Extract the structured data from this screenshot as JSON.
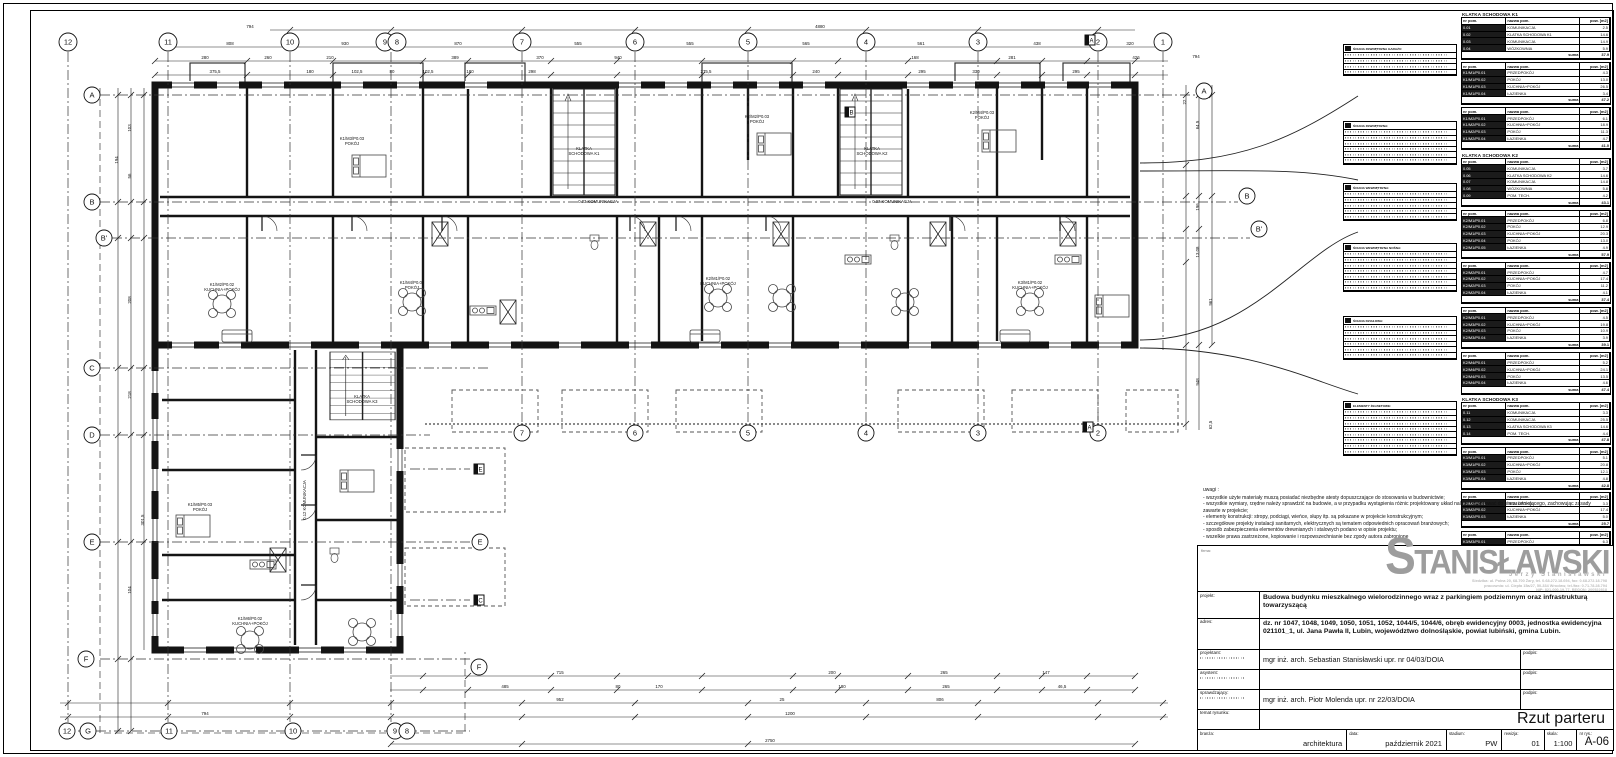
{
  "sheet": {
    "drawing_title": "Rzut parteru",
    "drawing_number": "A-06"
  },
  "notes": {
    "label": "uwagi :",
    "lines": [
      "- wszystkie użyte materiały muszą posiadać niezbędne atesty dopuszczające do stosowania w budownictwie;",
      "- wszystkie wymiary, rzędne należy sprawdzić na budowie, a w przypadku wystąpienia różnic projektowany układ należy dostosować do stanu istniejącego, zachowując zasady zawarte w projekcie;",
      "- elementy konstrukcji: stropy, podciągi, wieńce, słupy itp. są pokazane w projekcie konstrukcyjnym;",
      "- szczegółowe projekty instalacji sanitarnych, elektrycznych są tematem odpowiednich opracowań branżowych;",
      "- sposób zabezpieczenia elementów drewnianych i stalowych podano w opisie projektu;",
      "- wszelkie prawa zastrzeżone, kopiowanie i rozpowszechnianie bez zgody autora zabronione"
    ]
  },
  "logo": {
    "firma_label": "firma:",
    "name_initial": "S",
    "name_rest": "TANISŁAWSKI",
    "name_sub": "Jerzy Stanisławski",
    "addr1": "Siedziba: ul. Polna 20, 68-700 Żary, tel. 0.68.272.18.694, fax: 0.68.272.18.798",
    "addr2": "pracownia: ul. Ciepła 15a/27, 50-334 Wrocław, tel./fax: 0.71.78.28.794",
    "addr3": "NIP: 821-000-19-77, REGON: 200522818"
  },
  "titleblock": {
    "projekt_label": "projekt:",
    "projekt": "Budowa budynku mieszkalnego wielorodzinnego wraz z parkingiem podziemnym oraz infrastrukturą towarzyszącą",
    "adres_label": "adres:",
    "adres": "dz. nr 1047, 1048, 1049, 1050, 1051, 1052, 1044/5, 1044/6, obręb ewidencyjny 0003, jednostka ewidencyjna 021101_1, ul. Jana Pawła II, Lubin, województwo dolnośląskie, powiat lubiński, gmina Lubin.",
    "projektant_label": "projektant:",
    "projektant": "mgr inż. arch. Sebastian Stanisławski upr. nr 04/03/DOIA",
    "asystent_label": "asystent:",
    "asystent": "",
    "sprawdzajacy_label": "sprawdzający:",
    "sprawdzajacy": "mgr inż. arch. Piotr Molenda upr. nr 22/03/DOIA",
    "podpis_label": "podpis:",
    "temat_label": "temat rysunku:",
    "temat": "Rzut parteru",
    "bottom": [
      {
        "label": "branża:",
        "value": "architektura",
        "w": 150
      },
      {
        "label": "data:",
        "value": "październik 2021",
        "w": 100
      },
      {
        "label": "stadium:",
        "value": "PW",
        "w": 55
      },
      {
        "label": "rewizja:",
        "value": "01",
        "w": 42
      },
      {
        "label": "skala:",
        "value": "1:100",
        "w": 32
      },
      {
        "label": "nr rys.:",
        "value": "A-06",
        "w": 36,
        "big": true
      }
    ]
  },
  "legend": {
    "col_headers": [
      "nr pom.",
      "nazwa pom.",
      "pow. [m2]"
    ],
    "suma_label": "suma",
    "materials": [
      {
        "top": 33,
        "rows": 4,
        "title": "ŚCIANA ZEWNĘTRZNA GARAŻU:"
      },
      {
        "top": 110,
        "rows": 6,
        "title": "ŚCIANA ZEWNĘTRZNA:"
      },
      {
        "top": 172,
        "rows": 5,
        "title": "ŚCIANA WEWNĘTRZNA:"
      },
      {
        "top": 232,
        "rows": 7,
        "title": "ŚCIANA WEWNĘTRZNA NOŚNA:"
      },
      {
        "top": 305,
        "rows": 6,
        "title": "ŚCIANA DZIAŁOWA:"
      },
      {
        "top": 390,
        "rows": 8,
        "title": "ELEMENTY ŻELBETOWE:"
      }
    ],
    "sections": [
      {
        "title": "KLATKA SCHODOWA K1",
        "tables": [
          {
            "rows": [
              [
                "0.01",
                "KOMUNIKACJA",
                "2.5"
              ],
              [
                "0.02",
                "KLATKA SCHODOWA K1",
                "14.6"
              ],
              [
                "0.03",
                "KOMUNIKACJA",
                "14.9"
              ],
              [
                "0.04",
                "WÓZKOWNIA",
                "5.9"
              ]
            ],
            "sum": "37.9"
          },
          {
            "rows": [
              [
                "K1/M1/P0.01",
                "PRZEDPOKÓJ",
                "4.3"
              ],
              [
                "K1/M1/P0.02",
                "POKÓJ",
                "13.0"
              ],
              [
                "K1/M1/P0.03",
                "KUCHNIA+POKÓJ",
                "26.5"
              ],
              [
                "K1/M1/P0.04",
                "ŁAZIENKA",
                "3.4"
              ]
            ],
            "sum": "47.2"
          },
          {
            "rows": [
              [
                "K1/M2/P0.01",
                "PRZEDPOKÓJ",
                "6.1"
              ],
              [
                "K1/M2/P0.02",
                "KUCHNIA+POKÓJ",
                "18.9"
              ],
              [
                "K1/M2/P0.03",
                "POKÓJ",
                "11.3"
              ],
              [
                "K1/M2/P0.04",
                "ŁAZIENKA",
                "4.7"
              ]
            ],
            "sum": "41.0"
          }
        ]
      },
      {
        "title": "KLATKA SCHODOWA K2",
        "tables": [
          {
            "rows": [
              [
                "0.05",
                "KOMUNIKACJA",
                "3.7"
              ],
              [
                "0.06",
                "KLATKA SCHODOWA K2",
                "14.6"
              ],
              [
                "0.07",
                "KOMUNIKACJA",
                "14.8"
              ],
              [
                "0.08",
                "WÓZKOWNIA",
                "5.8"
              ],
              [
                "0.09",
                "POM. TECH.",
                "4.2"
              ]
            ],
            "sum": "43.1"
          },
          {
            "rows": [
              [
                "K2/M1/P0.01",
                "PRZEDPOKÓJ",
                "6.8"
              ],
              [
                "K2/M1/P0.02",
                "POKÓJ",
                "12.9"
              ],
              [
                "K2/M1/P0.03",
                "KUCHNIA+POKÓJ",
                "20.3"
              ],
              [
                "K2/M1/P0.04",
                "POKÓJ",
                "13.0"
              ],
              [
                "K2/M1/P0.05",
                "ŁAZIENKA",
                "4.9"
              ]
            ],
            "sum": "57.9"
          },
          {
            "rows": [
              [
                "K2/M2/P0.01",
                "PRZEDPOKÓJ",
                "4.7"
              ],
              [
                "K2/M2/P0.02",
                "KUCHNIA+POKÓJ",
                "17.4"
              ],
              [
                "K2/M2/P0.03",
                "POKÓJ",
                "11.2"
              ],
              [
                "K2/M2/P0.04",
                "ŁAZIENKA",
                "4.1"
              ]
            ],
            "sum": "37.4"
          },
          {
            "rows": [
              [
                "K2/M3/P0.01",
                "PRZEDPOKÓJ",
                "4.5"
              ],
              [
                "K2/M3/P0.02",
                "KUCHNIA+POKÓJ",
                "19.8"
              ],
              [
                "K2/M3/P0.03",
                "POKÓJ",
                "10.9"
              ],
              [
                "K2/M3/P0.04",
                "ŁAZIENKA",
                "3.9"
              ]
            ],
            "sum": "39.1"
          },
          {
            "rows": [
              [
                "K2/M4/P0.01",
                "PRZEDPOKÓJ",
                "5.2"
              ],
              [
                "K2/M4/P0.02",
                "KUCHNIA+POKÓJ",
                "24.1"
              ],
              [
                "K2/M4/P0.03",
                "POKÓJ",
                "13.5"
              ],
              [
                "K2/M4/P0.04",
                "ŁAZIENKA",
                "4.6"
              ]
            ],
            "sum": "47.4"
          }
        ]
      },
      {
        "title": "KLATKA SCHODOWA K3",
        "tables": [
          {
            "rows": [
              [
                "0.11",
                "KOMUNIKACJA",
                "3.3"
              ],
              [
                "0.12",
                "KOMUNIKACJA",
                "25.5"
              ],
              [
                "0.13",
                "KLATKA SCHODOWA K3",
                "14.6"
              ],
              [
                "0.14",
                "POM. TECH.",
                "4.4"
              ]
            ],
            "sum": "47.8"
          },
          {
            "rows": [
              [
                "K3/M1/P0.01",
                "PRZEDPOKÓJ",
                "5.1"
              ],
              [
                "K3/M1/P0.02",
                "KUCHNIA+POKÓJ",
                "20.8"
              ],
              [
                "K3/M1/P0.03",
                "POKÓJ",
                "12.1"
              ],
              [
                "K3/M1/P0.04",
                "ŁAZIENKA",
                "4.8"
              ]
            ],
            "sum": "42.8"
          },
          {
            "rows": [
              [
                "K3/M2/P0.01",
                "PRZEDPOKÓJ",
                "3.3"
              ],
              [
                "K3/M2/P0.02",
                "KUCHNIA+POKÓJ",
                "17.4"
              ],
              [
                "K3/M2/P0.03",
                "ŁAZIENKA",
                "5.0"
              ]
            ],
            "sum": "25.7"
          },
          {
            "rows": [
              [
                "K3/M3/P0.01",
                "PRZEDPOKÓJ",
                "6.3"
              ],
              [
                "K3/M3/P0.02",
                "KUCHNIA+POKÓJ",
                "27.2"
              ],
              [
                "K3/M3/P0.03",
                "POKÓJ",
                "15.1"
              ],
              [
                "K3/M3/P0.04",
                "ŁAZIENKA",
                "4.2"
              ]
            ],
            "sum": "52.8"
          }
        ]
      }
    ]
  },
  "plan": {
    "grid_top": [
      {
        "x": 68,
        "l": "12"
      },
      {
        "x": 168,
        "l": "11"
      },
      {
        "x": 290,
        "l": "10"
      },
      {
        "x": 385,
        "l": "9"
      },
      {
        "x": 397,
        "l": "8"
      },
      {
        "x": 522,
        "l": "7"
      },
      {
        "x": 635,
        "l": "6"
      },
      {
        "x": 748,
        "l": "5"
      },
      {
        "x": 866,
        "l": "4"
      },
      {
        "x": 978,
        "l": "3"
      },
      {
        "x": 1098,
        "l": "2"
      },
      {
        "x": 1163,
        "l": "1"
      }
    ],
    "grid_mid": [
      {
        "x": 522,
        "l": "7"
      },
      {
        "x": 635,
        "l": "6"
      },
      {
        "x": 748,
        "l": "5"
      },
      {
        "x": 866,
        "l": "4"
      },
      {
        "x": 978,
        "l": "3"
      },
      {
        "x": 1098,
        "l": "2"
      }
    ],
    "grid_bottom": [
      {
        "x": 67,
        "l": "12"
      },
      {
        "x": 169,
        "l": "11"
      },
      {
        "x": 293,
        "l": "10"
      },
      {
        "x": 395,
        "l": "9"
      },
      {
        "x": 407,
        "l": "8"
      }
    ],
    "letters_left": [
      {
        "x": 92,
        "y": 95,
        "l": "A"
      },
      {
        "x": 92,
        "y": 202,
        "l": "B"
      },
      {
        "x": 104,
        "y": 238,
        "l": "B'"
      },
      {
        "x": 92,
        "y": 368,
        "l": "C"
      },
      {
        "x": 92,
        "y": 435,
        "l": "D"
      },
      {
        "x": 92,
        "y": 542,
        "l": "E"
      },
      {
        "x": 86,
        "y": 659,
        "l": "F"
      },
      {
        "x": 88,
        "y": 731,
        "l": "G"
      }
    ],
    "letters_inner": [
      {
        "x": 480,
        "y": 542,
        "l": "E"
      },
      {
        "x": 479,
        "y": 667,
        "l": "F"
      }
    ],
    "letters_right": [
      {
        "x": 1204,
        "y": 91,
        "l": "A"
      },
      {
        "x": 1247,
        "y": 196,
        "l": "B"
      },
      {
        "x": 1259,
        "y": 229,
        "l": "B'"
      }
    ],
    "sq_markers": [
      {
        "x": 479,
        "y": 469,
        "l": "E"
      },
      {
        "x": 479,
        "y": 600,
        "l": "C"
      },
      {
        "x": 850,
        "y": 112,
        "l": "B"
      },
      {
        "x": 1090,
        "y": 40,
        "l": "A"
      },
      {
        "x": 1088,
        "y": 427,
        "l": "A"
      }
    ],
    "dims": [
      {
        "t": "794",
        "x": 250,
        "y": 28
      },
      {
        "t": "4880",
        "x": 820,
        "y": 28
      },
      {
        "t": "808",
        "x": 230,
        "y": 45
      },
      {
        "t": "930",
        "x": 345,
        "y": 45
      },
      {
        "t": "870",
        "x": 458,
        "y": 45
      },
      {
        "t": "555",
        "x": 578,
        "y": 45
      },
      {
        "t": "555",
        "x": 690,
        "y": 45
      },
      {
        "t": "565",
        "x": 806,
        "y": 45
      },
      {
        "t": "561",
        "x": 921,
        "y": 45
      },
      {
        "t": "438",
        "x": 1037,
        "y": 45
      },
      {
        "t": "320",
        "x": 1130,
        "y": 45
      },
      {
        "t": "794",
        "x": 1196,
        "y": 58
      },
      {
        "t": "280",
        "x": 205,
        "y": 59
      },
      {
        "t": "260",
        "x": 268,
        "y": 59
      },
      {
        "t": "210",
        "x": 330,
        "y": 59
      },
      {
        "t": "389",
        "x": 455,
        "y": 59
      },
      {
        "t": "370",
        "x": 540,
        "y": 59
      },
      {
        "t": "940",
        "x": 618,
        "y": 59
      },
      {
        "t": "168",
        "x": 915,
        "y": 59
      },
      {
        "t": "281",
        "x": 1012,
        "y": 59
      },
      {
        "t": "426",
        "x": 1136,
        "y": 59
      },
      {
        "t": "375,5",
        "x": 215,
        "y": 73
      },
      {
        "t": "180",
        "x": 310,
        "y": 73
      },
      {
        "t": "102,5",
        "x": 357,
        "y": 73
      },
      {
        "t": "80",
        "x": 392,
        "y": 73
      },
      {
        "t": "102,5",
        "x": 428,
        "y": 73
      },
      {
        "t": "180",
        "x": 470,
        "y": 73
      },
      {
        "t": "298",
        "x": 532,
        "y": 73
      },
      {
        "t": "275,5",
        "x": 706,
        "y": 73
      },
      {
        "t": "240",
        "x": 816,
        "y": 73
      },
      {
        "t": "295",
        "x": 922,
        "y": 73
      },
      {
        "t": "330",
        "x": 976,
        "y": 73
      },
      {
        "t": "295",
        "x": 1076,
        "y": 73
      },
      {
        "t": "715",
        "x": 560,
        "y": 674
      },
      {
        "t": "200",
        "x": 832,
        "y": 674
      },
      {
        "t": "265",
        "x": 944,
        "y": 674
      },
      {
        "t": "147",
        "x": 1046,
        "y": 674
      },
      {
        "t": "485",
        "x": 505,
        "y": 688
      },
      {
        "t": "80",
        "x": 618,
        "y": 688
      },
      {
        "t": "170",
        "x": 659,
        "y": 688
      },
      {
        "t": "180",
        "x": 842,
        "y": 688
      },
      {
        "t": "265",
        "x": 946,
        "y": 688
      },
      {
        "t": "46,5",
        "x": 1062,
        "y": 688
      },
      {
        "t": "952",
        "x": 560,
        "y": 701
      },
      {
        "t": "25",
        "x": 782,
        "y": 701
      },
      {
        "t": "806",
        "x": 940,
        "y": 701
      },
      {
        "t": "794",
        "x": 205,
        "y": 715
      },
      {
        "t": "1200",
        "x": 790,
        "y": 715
      },
      {
        "t": "2750",
        "x": 770,
        "y": 742
      },
      {
        "t": "194",
        "x": 118,
        "y": 160,
        "r": 1
      },
      {
        "t": "103",
        "x": 131,
        "y": 128,
        "r": 1
      },
      {
        "t": "56",
        "x": 131,
        "y": 176,
        "r": 1
      },
      {
        "t": "208",
        "x": 131,
        "y": 300,
        "r": 1
      },
      {
        "t": "218",
        "x": 131,
        "y": 395,
        "r": 1
      },
      {
        "t": "301,5",
        "x": 144,
        "y": 520,
        "r": 1
      },
      {
        "t": "104",
        "x": 131,
        "y": 590,
        "r": 1
      },
      {
        "t": "22",
        "x": 1186,
        "y": 102,
        "r": 1
      },
      {
        "t": "64,5",
        "x": 1199,
        "y": 125,
        "r": 1
      },
      {
        "t": "196",
        "x": 1199,
        "y": 207,
        "r": 1
      },
      {
        "t": "13,08",
        "x": 1199,
        "y": 252,
        "r": 1
      },
      {
        "t": "961",
        "x": 1212,
        "y": 302,
        "r": 1
      },
      {
        "t": "948",
        "x": 1199,
        "y": 382,
        "r": 1
      },
      {
        "t": "62,5",
        "x": 1212,
        "y": 425,
        "r": 1
      }
    ],
    "rooms": [
      {
        "x": 598,
        "y": 203,
        "a": "0.03 KOMUNIKACJA",
        "b": ""
      },
      {
        "x": 892,
        "y": 203,
        "a": "0.07 KOMUNIKACJA",
        "b": ""
      },
      {
        "x": 584,
        "y": 150,
        "a": "KLATKA",
        "b": "SCHODOWA K1"
      },
      {
        "x": 872,
        "y": 150,
        "a": "KLATKA",
        "b": "SCHODOWA K2"
      },
      {
        "x": 362,
        "y": 398,
        "a": "KLATKA",
        "b": "SCHODOWA K3"
      },
      {
        "x": 222,
        "y": 286,
        "a": "K1/M2/P0.02",
        "b": "KUCHNIA+POKÓJ"
      },
      {
        "x": 412,
        "y": 284,
        "a": "K1/M4/P0.03",
        "b": "POKÓJ"
      },
      {
        "x": 718,
        "y": 280,
        "a": "K2/M1/P0.02",
        "b": "KUCHNIA+POKÓJ"
      },
      {
        "x": 1030,
        "y": 284,
        "a": "K3/M1/P0.02",
        "b": "KUCHNIA+POKÓJ"
      },
      {
        "x": 757,
        "y": 118,
        "a": "K2/M2/P0.03",
        "b": "POKÓJ"
      },
      {
        "x": 982,
        "y": 114,
        "a": "K2/M4/P0.03",
        "b": "POKÓJ"
      },
      {
        "x": 352,
        "y": 140,
        "a": "K1/M3/P0.03",
        "b": "POKÓJ"
      },
      {
        "x": 250,
        "y": 620,
        "a": "K1/M6/P0.02",
        "b": "KUCHNIA+POKÓJ"
      },
      {
        "x": 200,
        "y": 506,
        "a": "K1/M5/P0.03",
        "b": "POKÓJ"
      },
      {
        "x": 306,
        "y": 500,
        "a": "0.12 KOMUNIKACJA",
        "b": "",
        "r": 1
      }
    ]
  }
}
